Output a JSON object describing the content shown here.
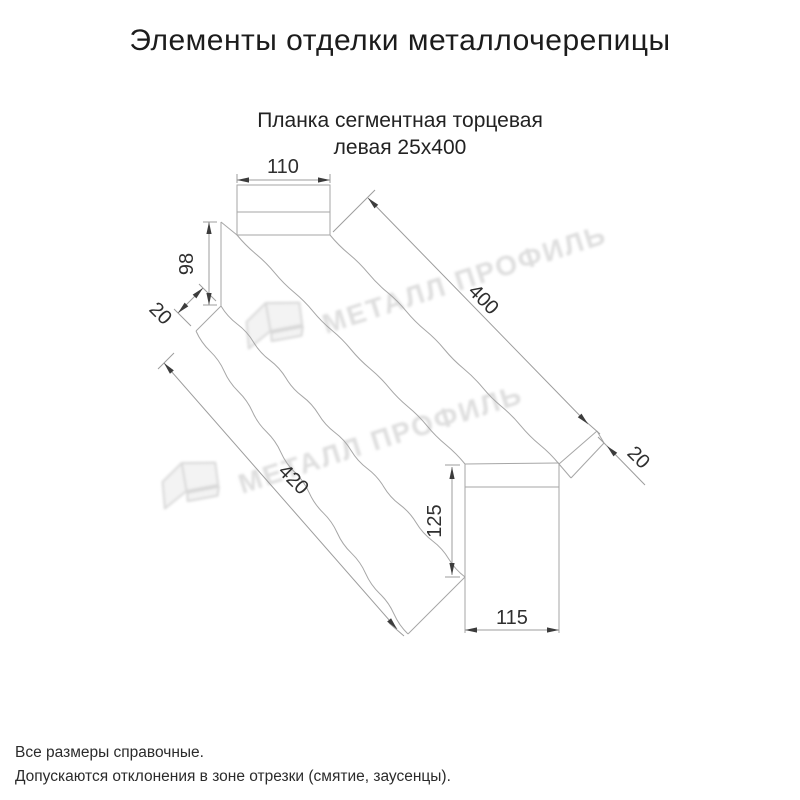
{
  "page": {
    "title": "Элементы отделки металлочерепицы",
    "subtitle_line1": "Планка сегментная торцевая",
    "subtitle_line2": "левая 25х400"
  },
  "watermark": {
    "text": "МЕТАЛЛ ПРОФИЛЬ"
  },
  "drawing": {
    "dimensions": {
      "top_width": "110",
      "left_end_height": "98",
      "left_flap": "20",
      "length_top": "400",
      "length_bottom": "420",
      "right_flap": "20",
      "right_end_height": "125",
      "right_end_width": "115"
    }
  },
  "footnotes": {
    "line1": "Все размеры справочные.",
    "line2": "Допускаются отклонения в зоне отрезки (смятие, заусенцы)."
  },
  "colors": {
    "drawing_line": "#a6a6a6",
    "dimension_text": "#2f2f2f",
    "watermark_gray": "#dedede"
  }
}
